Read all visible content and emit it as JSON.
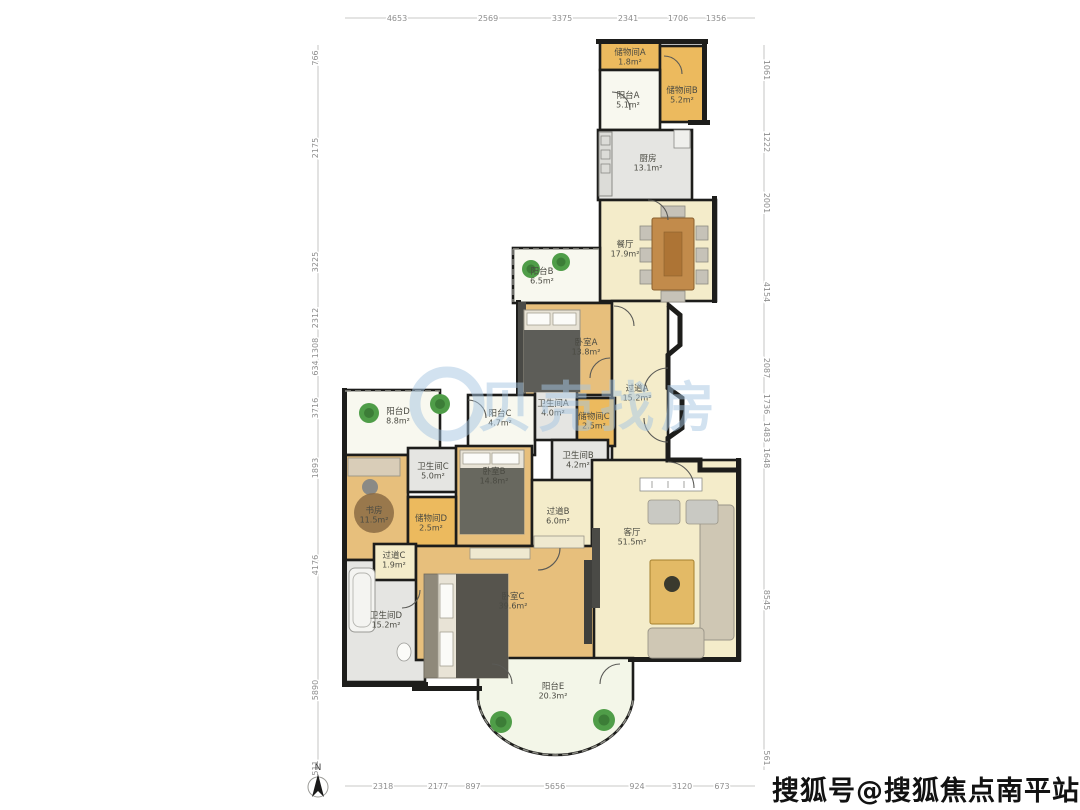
{
  "watermarks": {
    "center_logo_text": "贝壳找房",
    "bottom_right": "搜狐号@搜狐焦点南平站"
  },
  "compass": {
    "label": "N"
  },
  "colors": {
    "wood": "#e7bf7c",
    "cream": "#f4ecca",
    "gray": "#e5e5e2",
    "yellow": "#ecba5e",
    "balcony": "#f8f8ef",
    "palegreen": "#f3f6e8",
    "wall": "#1d1d1b",
    "watermark_blue": "#a6c6e2",
    "plant_green": "#4f9d48",
    "dim_text": "#8e8e8e"
  },
  "rooms": [
    {
      "id": "storage-a",
      "label": "储物间A",
      "area": "1.8m²",
      "fill": "yellow",
      "rect": [
        600,
        42,
        60,
        28
      ],
      "lx": 630,
      "ly": 57
    },
    {
      "id": "storage-b",
      "label": "储物间B",
      "area": "5.2m²",
      "fill": "yellow",
      "rect": [
        660,
        46,
        45,
        76
      ],
      "lx": 682,
      "ly": 95
    },
    {
      "id": "balcony-a",
      "label": "阳台A",
      "area": "5.1m²",
      "fill": "balcony",
      "rect": [
        600,
        70,
        60,
        60
      ],
      "lx": 628,
      "ly": 100
    },
    {
      "id": "kitchen",
      "label": "厨房",
      "area": "13.1m²",
      "fill": "gray",
      "rect": [
        598,
        130,
        94,
        70
      ],
      "lx": 648,
      "ly": 163
    },
    {
      "id": "dining",
      "label": "餐厅",
      "area": "17.9m²",
      "fill": "cream",
      "rect": [
        600,
        200,
        116,
        101
      ],
      "lx": 625,
      "ly": 249
    },
    {
      "id": "balcony-b",
      "label": "阳台B",
      "area": "6.5m²",
      "fill": "balcony",
      "rect": [
        513,
        248,
        87,
        55
      ],
      "lx": 542,
      "ly": 276
    },
    {
      "id": "bedroom-a",
      "label": "卧室A",
      "area": "13.8m²",
      "fill": "wood",
      "rect": [
        520,
        303,
        92,
        92
      ],
      "lx": 586,
      "ly": 347
    },
    {
      "id": "hall-a",
      "label": "过道A",
      "area": "15.2m²",
      "fill": "cream",
      "rect": [
        612,
        301,
        56,
        160
      ],
      "lx": 637,
      "ly": 393
    },
    {
      "id": "balcony-d",
      "label": "阳台D",
      "area": "8.8m²",
      "fill": "balcony",
      "rect": [
        345,
        390,
        95,
        65
      ],
      "lx": 398,
      "ly": 416
    },
    {
      "id": "balcony-c",
      "label": "阳台C",
      "area": "4.7m²",
      "fill": "balcony",
      "rect": [
        468,
        395,
        67,
        60
      ],
      "lx": 500,
      "ly": 418
    },
    {
      "id": "bath-a",
      "label": "卫生间A",
      "area": "4.0m²",
      "fill": "gray",
      "rect": [
        535,
        388,
        42,
        52
      ],
      "lx": 553,
      "ly": 408
    },
    {
      "id": "storage-c",
      "label": "储物间C",
      "area": "2.5m²",
      "fill": "yellow",
      "rect": [
        577,
        398,
        38,
        48
      ],
      "lx": 594,
      "ly": 421
    },
    {
      "id": "bath-b",
      "label": "卫生间B",
      "area": "4.2m²",
      "fill": "gray",
      "rect": [
        552,
        440,
        56,
        42
      ],
      "lx": 578,
      "ly": 460
    },
    {
      "id": "study",
      "label": "书房",
      "area": "11.5m²",
      "fill": "wood",
      "rect": [
        345,
        455,
        63,
        105
      ],
      "lx": 374,
      "ly": 515
    },
    {
      "id": "bath-c",
      "label": "卫生间C",
      "area": "5.0m²",
      "fill": "gray",
      "rect": [
        408,
        448,
        52,
        44
      ],
      "lx": 433,
      "ly": 471
    },
    {
      "id": "bedroom-b",
      "label": "卧室B",
      "area": "14.8m²",
      "fill": "wood",
      "rect": [
        456,
        446,
        76,
        100
      ],
      "lx": 494,
      "ly": 476
    },
    {
      "id": "storage-d",
      "label": "储物间D",
      "area": "2.5m²",
      "fill": "yellow",
      "rect": [
        408,
        497,
        48,
        49
      ],
      "lx": 431,
      "ly": 523
    },
    {
      "id": "hall-b",
      "label": "过道B",
      "area": "6.0m²",
      "fill": "cream",
      "rect": [
        532,
        480,
        60,
        70
      ],
      "lx": 558,
      "ly": 516
    },
    {
      "id": "living",
      "label": "客厅",
      "area": "51.5m²",
      "fill": "cream",
      "rect": [
        592,
        460,
        148,
        200
      ],
      "lx": 632,
      "ly": 537
    },
    {
      "id": "bath-d",
      "label": "卫生间D",
      "area": "15.2m²",
      "fill": "gray",
      "rect": [
        345,
        560,
        80,
        122
      ],
      "lx": 386,
      "ly": 620
    },
    {
      "id": "hall-c",
      "label": "过道C",
      "area": "1.9m²",
      "fill": "cream",
      "rect": [
        374,
        544,
        42,
        36
      ],
      "lx": 394,
      "ly": 560
    },
    {
      "id": "bedroom-c",
      "label": "卧室C",
      "area": "39.6m²",
      "fill": "wood",
      "rect": [
        416,
        546,
        178,
        114
      ],
      "lx": 513,
      "ly": 601
    },
    {
      "id": "balcony-e",
      "label": "阳台E",
      "area": "20.3m²",
      "fill": "palegreen",
      "path": "M478,658 L633,658 L633,700 A78,62 0 0 1 478,700 Z",
      "lx": 553,
      "ly": 691
    }
  ],
  "dimensions": {
    "top": {
      "y": 18,
      "labels": [
        {
          "text": "4653",
          "pos": 397
        },
        {
          "text": "2569",
          "pos": 488
        },
        {
          "text": "3375",
          "pos": 562
        },
        {
          "text": "2341",
          "pos": 628
        },
        {
          "text": "1706",
          "pos": 678
        },
        {
          "text": "1356",
          "pos": 716
        }
      ]
    },
    "bottom": {
      "y": 786,
      "labels": [
        {
          "text": "2318",
          "pos": 383
        },
        {
          "text": "2177",
          "pos": 438
        },
        {
          "text": "897",
          "pos": 473
        },
        {
          "text": "5656",
          "pos": 555
        },
        {
          "text": "924",
          "pos": 637
        },
        {
          "text": "3120",
          "pos": 682
        },
        {
          "text": "673",
          "pos": 722
        }
      ]
    },
    "left": {
      "x": 318,
      "labels": [
        {
          "text": "766",
          "pos": 58
        },
        {
          "text": "2175",
          "pos": 148
        },
        {
          "text": "3225",
          "pos": 262
        },
        {
          "text": "2312",
          "pos": 318
        },
        {
          "text": "1308",
          "pos": 348
        },
        {
          "text": "634",
          "pos": 368
        },
        {
          "text": "3716",
          "pos": 408
        },
        {
          "text": "1893",
          "pos": 468
        },
        {
          "text": "4176",
          "pos": 565
        },
        {
          "text": "5890",
          "pos": 690
        },
        {
          "text": "511",
          "pos": 768
        }
      ]
    },
    "right": {
      "x": 764,
      "labels": [
        {
          "text": "1061",
          "pos": 70
        },
        {
          "text": "1222",
          "pos": 142
        },
        {
          "text": "2001",
          "pos": 203
        },
        {
          "text": "4154",
          "pos": 292
        },
        {
          "text": "2087",
          "pos": 368
        },
        {
          "text": "1736",
          "pos": 404
        },
        {
          "text": "1483",
          "pos": 432
        },
        {
          "text": "1648",
          "pos": 458
        },
        {
          "text": "8545",
          "pos": 600
        },
        {
          "text": "561",
          "pos": 758
        }
      ]
    }
  }
}
